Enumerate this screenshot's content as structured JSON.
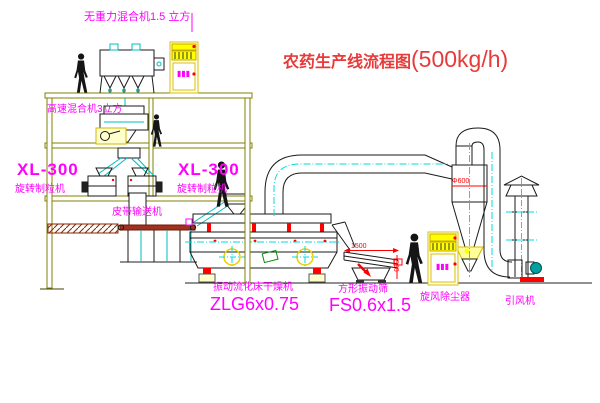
{
  "title": {
    "text": "农药生产线流程图",
    "capacity": "(500kg/h)"
  },
  "equipment_labels": {
    "gravity_free_mixer": "无重力混合机1.5 立方",
    "high_speed_mixer": "高速混合机3立方",
    "granulator_left_model": "XL-300",
    "granulator_left_name": "旋转制粒机",
    "granulator_right_model": "XL-300",
    "granulator_right_name": "旋转制粒机",
    "belt_conveyor": "皮带输送机",
    "fluid_bed_dryer_name": "振动流化床干燥机",
    "fluid_bed_dryer_model": "ZLG6x0.75",
    "vibrating_sieve_name": "方形振动筛",
    "vibrating_sieve_model": "FS0.6x1.5",
    "cyclone": "旋风除尘器",
    "induced_draft_fan": "引风机"
  },
  "dimensions": {
    "sieve_length": "1500",
    "sieve_height": "550",
    "cyclone_diameter": "Φ600"
  },
  "cabinet_marking": "▮▮▮",
  "colors": {
    "structure": "#808000",
    "machine_highlight": "#ffff00",
    "pipe_centerline": "#00dede",
    "label_text": "#ff00ff",
    "title_text": "#e83a3a",
    "conveyor_band": "#a03020",
    "motor_teal": "#00a0a0",
    "status_red": "#ff0000"
  }
}
